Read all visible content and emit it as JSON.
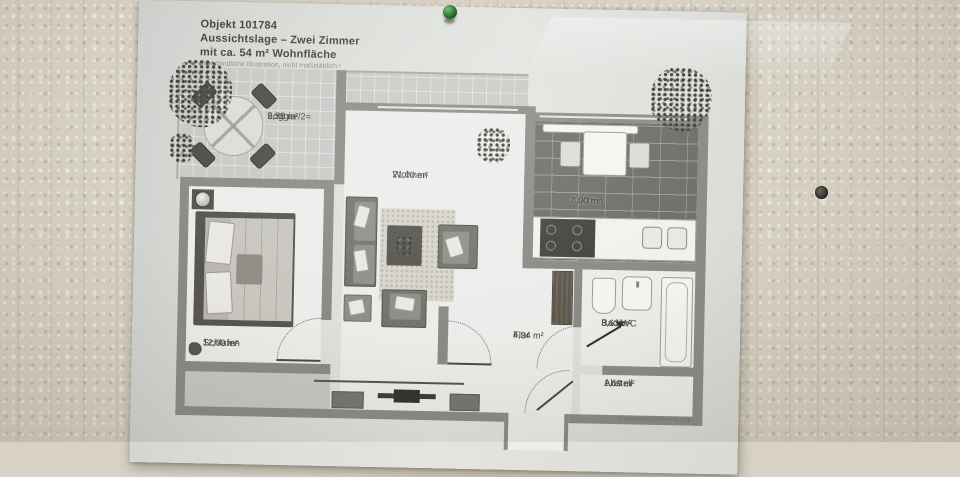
{
  "photo": {
    "pin_color": "#2e7d32",
    "wall_color": "#d8d2c5",
    "paper_color": "#dcdeda"
  },
  "document": {
    "header": {
      "object_line": "Objekt 101784",
      "title_line": "Aussichtslage – Zwei Zimmer",
      "area_line": "mit ca. 54 m² Wohnfläche",
      "disclaimer": "unverbindliche Illustration, nicht maßstäblich !"
    },
    "watermark": "IllustrationZimmerGrafik",
    "rooms": [
      {
        "id": "loggia",
        "name": "Loggia",
        "area": "5,50 m²/2=",
        "area2": "2,75 m²"
      },
      {
        "id": "wohnen",
        "name": "Wohnen",
        "area": "21,00 m²"
      },
      {
        "id": "kochen",
        "name": "Kochen",
        "area": "8,00 m²"
      },
      {
        "id": "schlafen",
        "name": "Schlafen",
        "area": "12,00 m²"
      },
      {
        "id": "flur",
        "name": "Flur",
        "area": "4,34 m²"
      },
      {
        "id": "bad",
        "name": "Bad/WC",
        "area": "3,63 m²"
      },
      {
        "id": "abstell",
        "name": "Abstell",
        "area": "1,68 m²"
      }
    ]
  }
}
